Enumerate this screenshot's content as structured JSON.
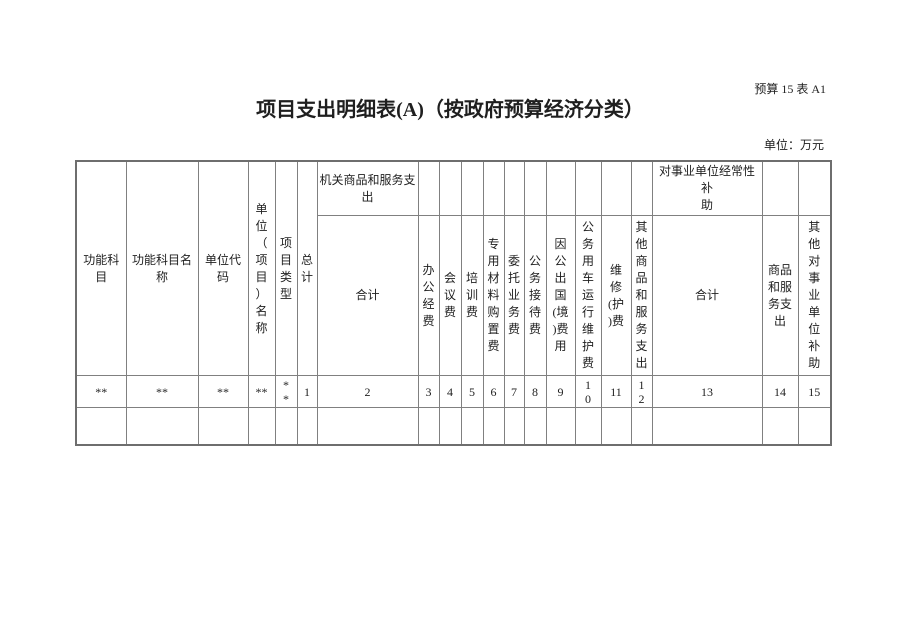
{
  "page": {
    "doc_label": "预算 15 表 A1",
    "title": "项目支出明细表(A)（按政府预算经济分类）",
    "unit_label": "单位：万元"
  },
  "colors": {
    "background": "#ffffff",
    "border": "#808080",
    "text": "#1f1f1f"
  },
  "table": {
    "left_headers": [
      {
        "label": "功能科\n目"
      },
      {
        "label": "功能科目名\n称"
      },
      {
        "label": "单位代\n码"
      },
      {
        "label": "单\n位\n（\n项\n目\n）\n名\n称"
      },
      {
        "label": "项\n目\n类\n型"
      },
      {
        "label": "总\n计"
      }
    ],
    "groups": [
      {
        "label": "机关商品和服务支\n出"
      },
      {
        "label": "对事业单位经常性补\n助"
      }
    ],
    "sub_headers": [
      {
        "label": "合计"
      },
      {
        "label": "办\n公\n经\n费"
      },
      {
        "label": "会\n议\n费"
      },
      {
        "label": "培\n训\n费"
      },
      {
        "label": "专\n用\n材\n料\n购\n置\n费"
      },
      {
        "label": "委\n托\n业\n务\n费"
      },
      {
        "label": "公\n务\n接\n待\n费"
      },
      {
        "label": "因\n公\n出\n国\n(境\n)费\n用"
      },
      {
        "label": "公\n务\n用\n车\n运\n行\n维\n护\n费"
      },
      {
        "label": "维\n修\n(护\n)费"
      },
      {
        "label": "其\n他\n商\n品\n和\n服\n务\n支\n出"
      },
      {
        "label": "合计"
      },
      {
        "label": "商品\n和服\n务支\n出"
      },
      {
        "label": "其\n他\n对\n事\n业\n单\n位\n补\n助"
      }
    ],
    "data_row": [
      "**",
      "**",
      "**",
      "**",
      "*\n*",
      "1",
      "2",
      "3",
      "4",
      "5",
      "6",
      "7",
      "8",
      "9",
      "1\n0",
      "11",
      "1\n2",
      "13",
      "14",
      "15"
    ]
  }
}
